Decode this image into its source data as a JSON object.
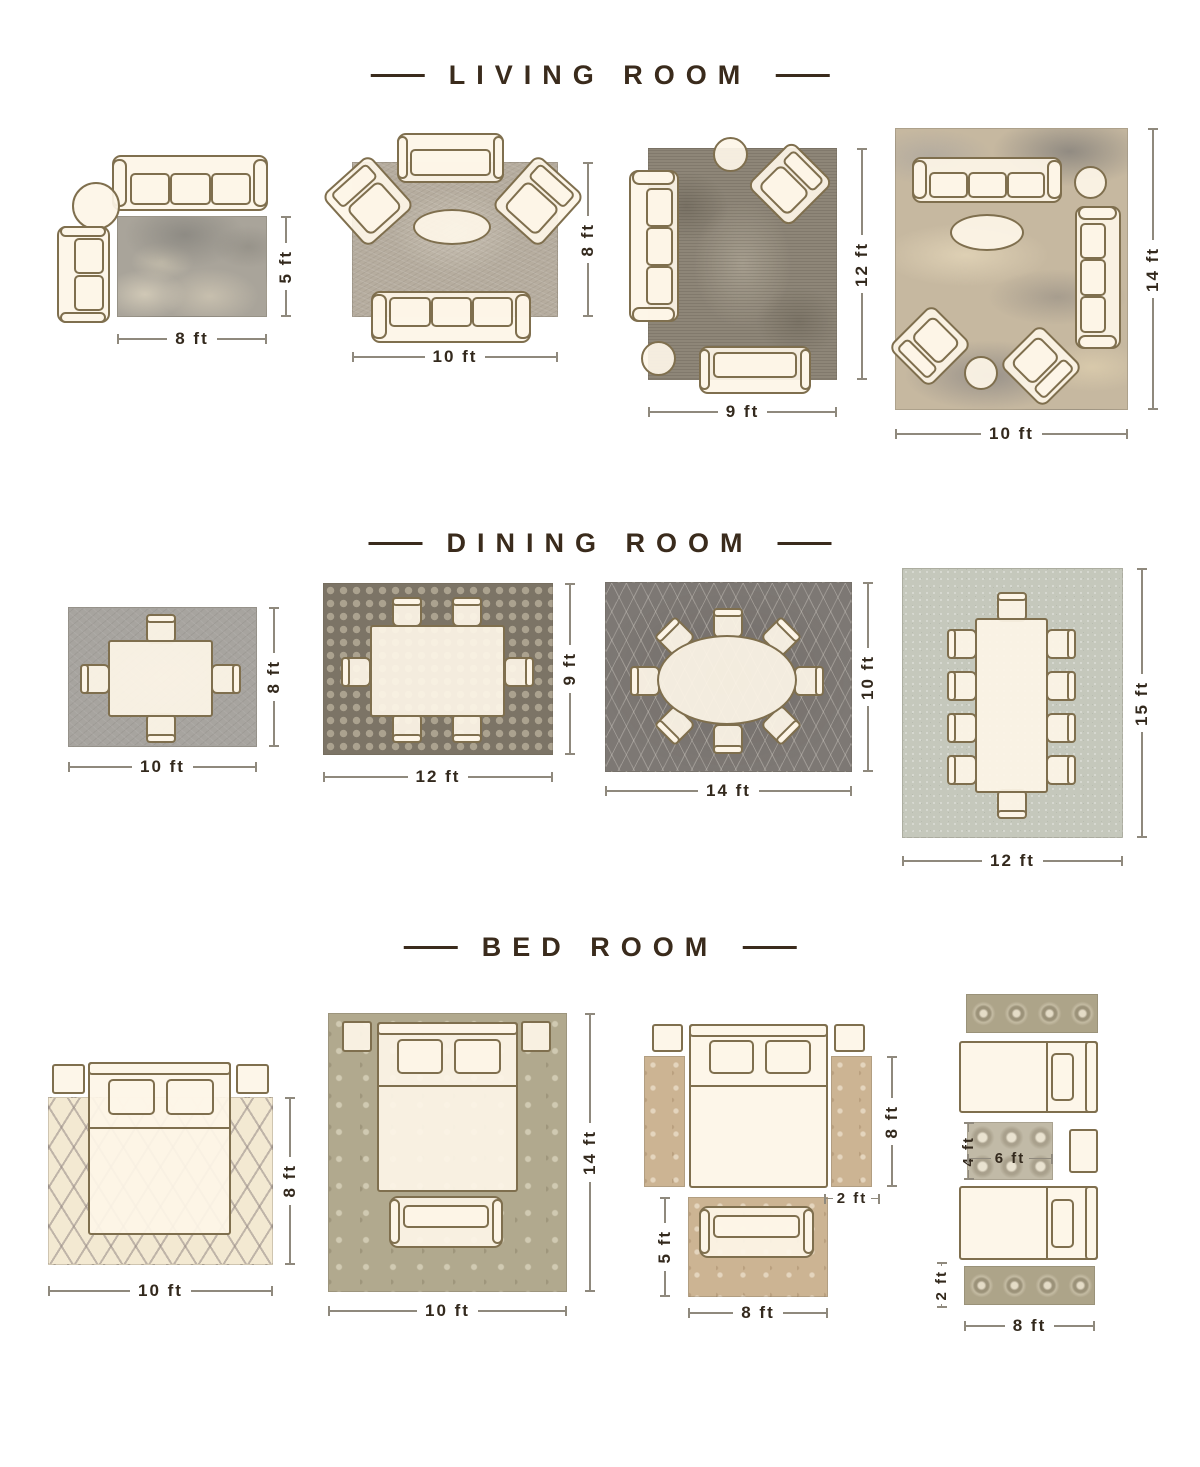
{
  "colors": {
    "background": "#ffffff",
    "title_text": "#3a2b1c",
    "dimension_text": "#33291d",
    "dimension_line": "#8f897d",
    "furniture_fill": "#fdf5e8",
    "furniture_outline": "#7f6f4e"
  },
  "sections": [
    {
      "name": "living-room",
      "title": "LIVING ROOM",
      "layouts": [
        {
          "name": "rug-8x5",
          "width": "8 ft",
          "height": "5 ft"
        },
        {
          "name": "rug-10x8",
          "width": "10 ft",
          "height": "8 ft"
        },
        {
          "name": "rug-9x12",
          "width": "9 ft",
          "height": "12 ft"
        },
        {
          "name": "rug-10x14",
          "width": "10 ft",
          "height": "14 ft"
        }
      ]
    },
    {
      "name": "dining-room",
      "title": "DINING ROOM",
      "layouts": [
        {
          "name": "rug-10x8",
          "width": "10 ft",
          "height": "8 ft"
        },
        {
          "name": "rug-12x9",
          "width": "12 ft",
          "height": "9 ft"
        },
        {
          "name": "rug-14x10",
          "width": "14 ft",
          "height": "10 ft"
        },
        {
          "name": "rug-12x15",
          "width": "12 ft",
          "height": "15 ft"
        }
      ]
    },
    {
      "name": "bed-room",
      "title": "BED ROOM",
      "layouts": [
        {
          "name": "rug-10x8",
          "width": "10 ft",
          "height": "8 ft"
        },
        {
          "name": "rug-10x14",
          "width": "10 ft",
          "height": "14 ft"
        },
        {
          "name": "runners-and-foot-rug",
          "side_runner_height": "8 ft",
          "side_runner_width": "2 ft",
          "foot_rug_height": "5 ft",
          "foot_rug_width": "8 ft"
        },
        {
          "name": "twin-beds-with-runners",
          "center_rug_height": "4 ft",
          "center_rug_width": "6 ft",
          "runner_height": "2 ft",
          "runner_width": "8 ft"
        }
      ]
    }
  ]
}
